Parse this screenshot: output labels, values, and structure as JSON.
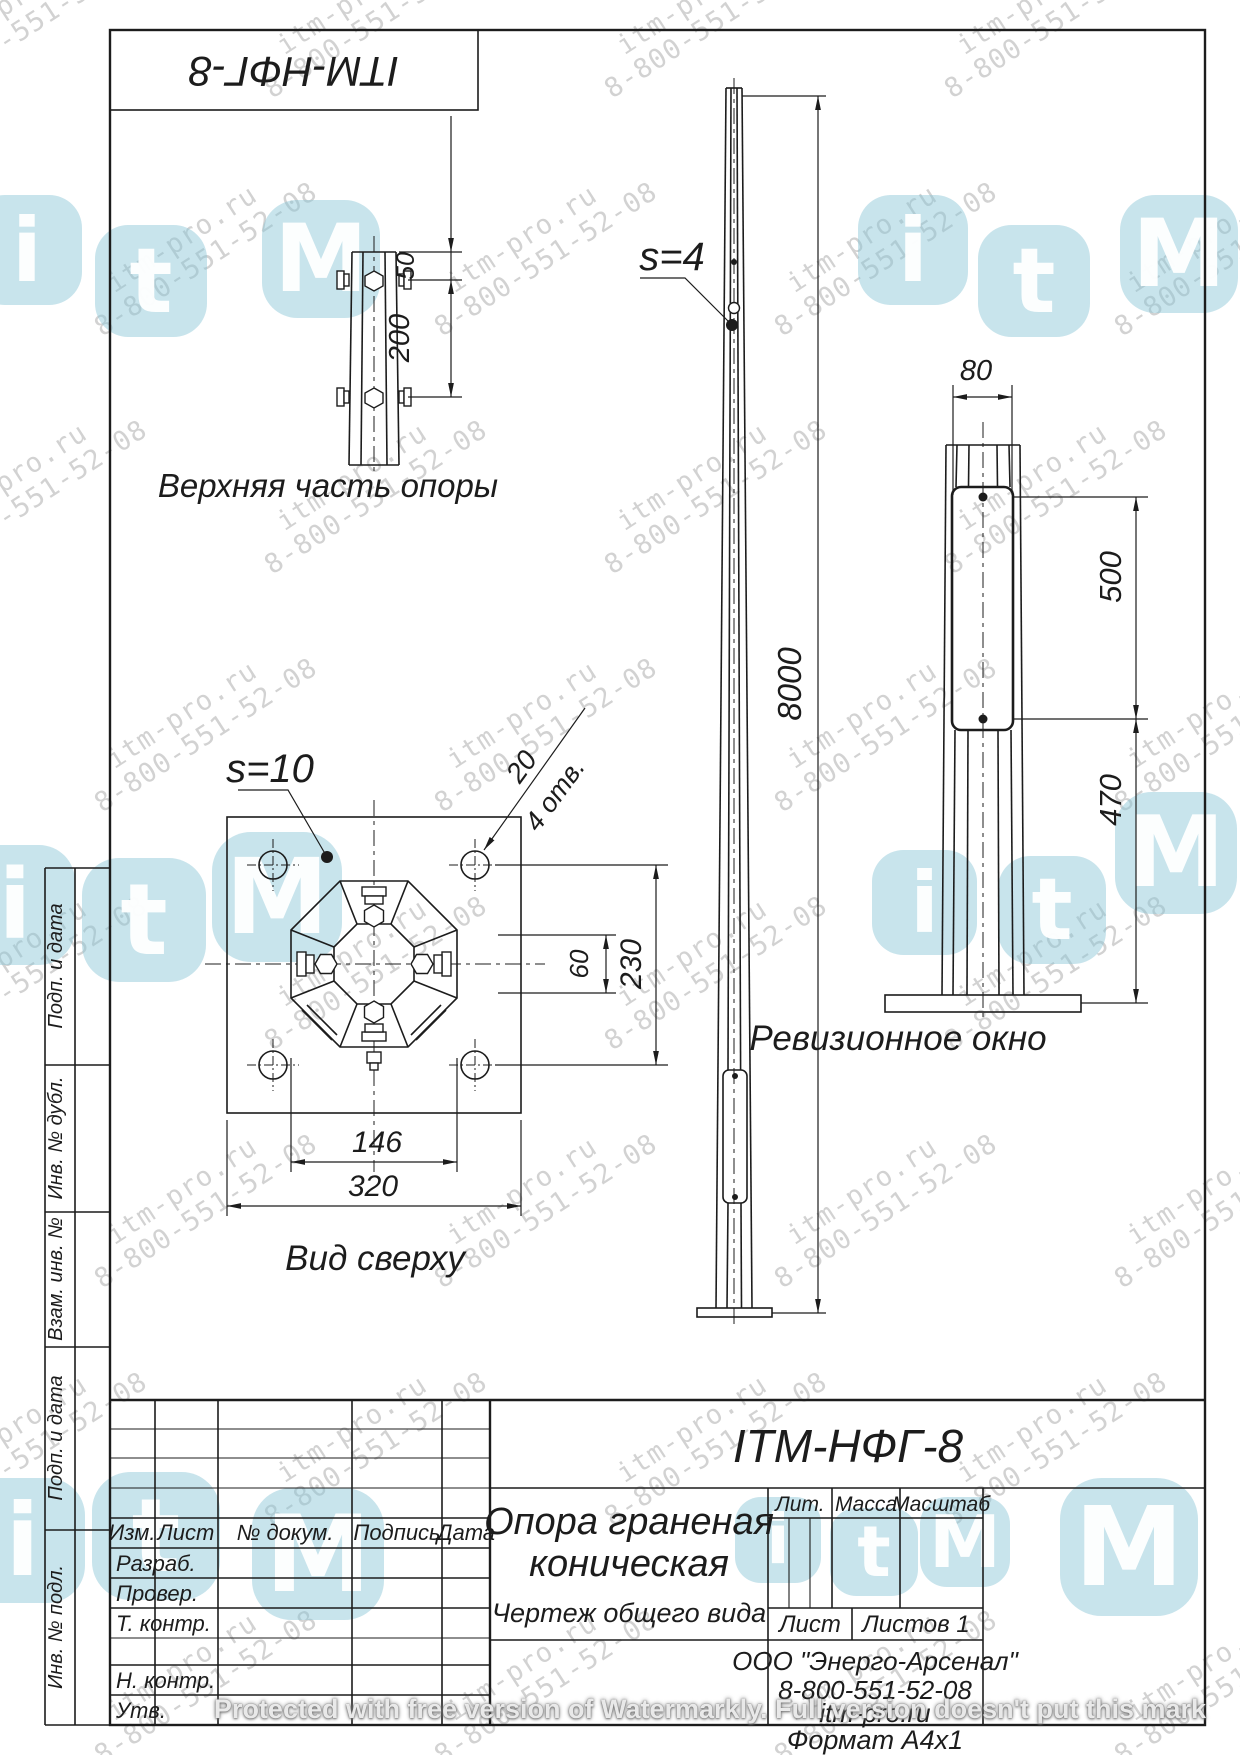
{
  "stamp_top": {
    "title": "ITM-НФГ-8"
  },
  "watermark": {
    "line1": "itm-pro.ru",
    "line2": "8-800-551-52-08",
    "protected": "Protected with free version of Watermarkly. Full version doesn't put this mark",
    "logo_letters": [
      "i",
      "t",
      "M"
    ]
  },
  "views": {
    "upper_detail": {
      "label": "Верхняя часть опоры",
      "dim_top": "50",
      "dim_bolts": "200"
    },
    "front": {
      "thickness": "s=4",
      "dim_height": "8000"
    },
    "window_detail": {
      "label": "Ревизионное окно",
      "dim_width": "80",
      "dim_window": "500",
      "dim_bottom": "470"
    },
    "top_view": {
      "label": "Вид сверху",
      "thickness": "s=10",
      "dim_hole": "20",
      "dim_hole_count": "4 отв.",
      "dim_60": "60",
      "dim_230": "230",
      "dim_146": "146",
      "dim_320": "320"
    }
  },
  "title_block": {
    "doc_number": "ITM-НФГ-8",
    "name_line1": "Опора граненая",
    "name_line2": "коническая",
    "doc_type": "Чертеж общего вида",
    "lit": "Лит.",
    "massa": "Масса",
    "masshtab": "Масштаб",
    "list": "Лист",
    "listov": "Листов 1",
    "izm": "Изм.",
    "list_col": "Лист",
    "n_dokum": "№ докум.",
    "podpis": "Подпись",
    "data_col": "Дата",
    "razrab": "Разраб.",
    "prover": "Провер.",
    "t_kontr": "Т. контр.",
    "n_kontr": "Н. контр.",
    "utv": "Утв.",
    "company": "ООО \"Энерго-Арсенал\"",
    "phone": "8-800-551-52-08",
    "site": "itm-pro.ru",
    "format": "Формат  А4х1"
  },
  "side_labels": {
    "podp_data_1": "Подп. и дата",
    "inv_dubl": "Инв. № дубл.",
    "vzam_inv": "Взам. инв. №",
    "podp_data_2": "Подп. и дата",
    "inv_podl": "Инв. № подл."
  },
  "colors": {
    "line": "#1c1c1c",
    "watermark_text": "#c7c7c7",
    "logo_blue": "#8cc6d8",
    "paper": "#ffffff"
  }
}
